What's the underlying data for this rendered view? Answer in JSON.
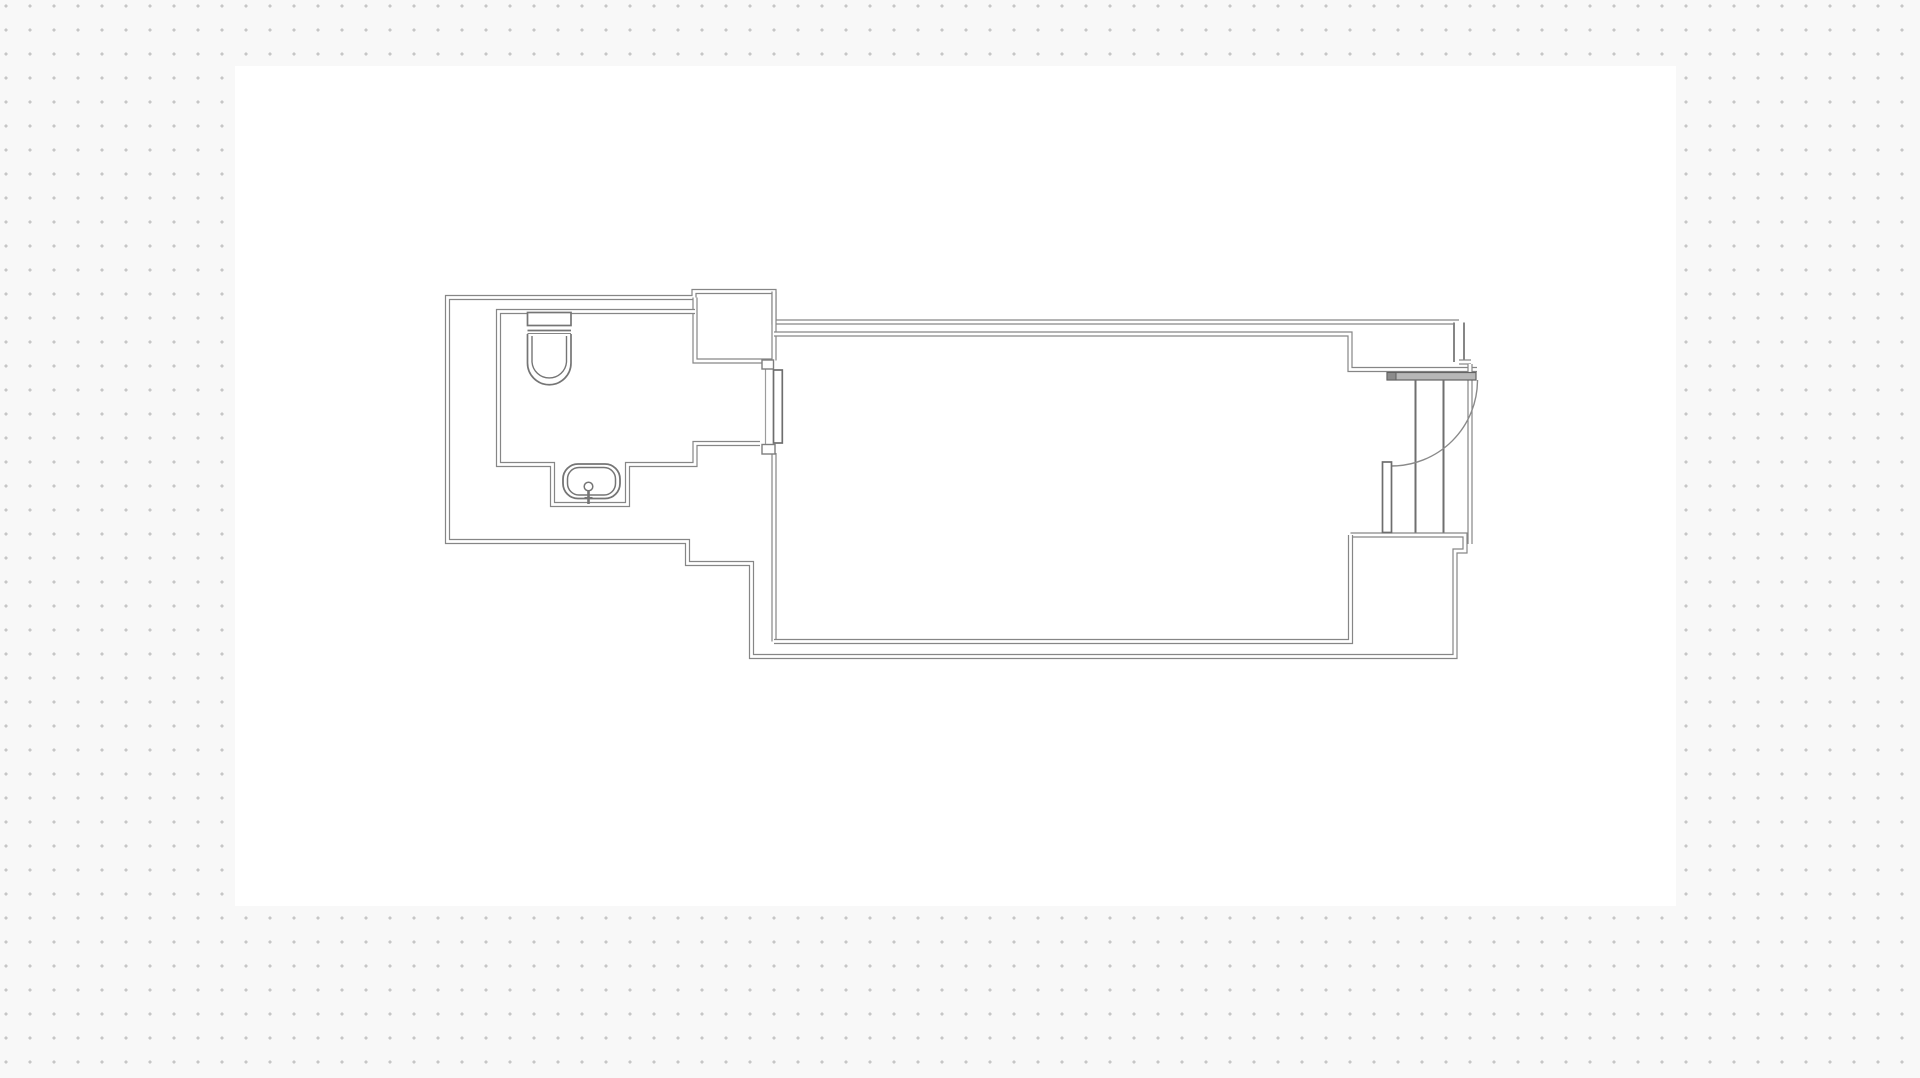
{
  "canvas": {
    "width": 1920,
    "height": 1078,
    "background_color": "#f8f8f8",
    "dot_color": "#c6c6c6",
    "dot_spacing_px": 24,
    "artboard": {
      "x": 235,
      "y": 66,
      "width": 1441,
      "height": 840,
      "color": "#ffffff"
    }
  },
  "floorplan": {
    "wall_color": "#868686",
    "wall_core_color": "#ffffff",
    "fixture_color": "#757575",
    "detail_color": "#6f6f6f",
    "walls": [
      {
        "name": "wall-outer-boundary",
        "d": "M 1350.5 535 H 1465 V 551 H 1455 V 656.5 H 751.5 V 563.5 H 687.5 V 541.5 H 447.5 V 297.5 H 694 V 291.5 H 774 V 322 H 1459",
        "thick": false
      },
      {
        "name": "wall-top-right-corner",
        "d": "M 1459 322.5 V 362",
        "thick": true
      },
      {
        "name": "wall-top-right-step",
        "d": "M 1459 362 H 1471",
        "thick": false
      },
      {
        "name": "wall-closet-niche",
        "d": "M 695 297.5 V 361 H 773",
        "thick": false
      },
      {
        "name": "wall-hall-upper",
        "d": "M 774 291.5 V 360.5",
        "thick": false
      },
      {
        "name": "wall-hall-lower",
        "d": "M 774 453 V 641.5",
        "thick": false
      },
      {
        "name": "wall-bathroom",
        "d": "M 695 311.5 H 498.5 V 464.5 H 552.5 V 504.5 H 627.5 V 464.5 H 695 V 443.5 H 760",
        "thick": false
      },
      {
        "name": "wall-main-room-top-inner",
        "d": "M 774 334 H 1350 V 369.5 H 1477",
        "thick": false
      },
      {
        "name": "wall-main-room-bottom-inner",
        "d": "M 774 641.5 H 1350.5 V 535",
        "thick": false
      },
      {
        "name": "wall-entry-jamb",
        "d": "M 1470 364 V 544",
        "thick": false
      }
    ],
    "bathroom_door": {
      "sill": "M 765.5 366 V 447",
      "leaf": {
        "x": 773.5,
        "y": 370,
        "width": 8.8,
        "height": 73
      },
      "caps": [
        {
          "x": 762,
          "y": 360,
          "width": 11.5,
          "height": 9
        },
        {
          "x": 762,
          "y": 444.5,
          "width": 13,
          "height": 9.5
        }
      ]
    },
    "entry_door": {
      "threshold": {
        "x": 1387,
        "y": 372.5,
        "width": 89,
        "height": 7.5,
        "fill": "#b7b7b7",
        "stroke": "#636363"
      },
      "cap": {
        "x": 1387,
        "y": 372.5,
        "width": 9,
        "height": 7.5,
        "fill": "#8b8b8b",
        "stroke": "#5f5f5f"
      },
      "tracks": [
        "M 1415.5 380 V 532.5",
        "M 1443.5 380 V 532.5"
      ],
      "swing_arc": "M 1477.5 380 A 86 86 0 0 1 1391.5 466",
      "leaf": {
        "x": 1382.5,
        "y": 462,
        "width": 9,
        "height": 70.5
      }
    },
    "toilet": {
      "tank": {
        "x": 527.5,
        "y": 312.5,
        "width": 43.5,
        "height": 13
      },
      "seam": [
        "M 527.5 330.5 H 571",
        "M 527.5 334 H 571"
      ],
      "bowl_outer": "M 527.5 334 L 527.5 363 A 21.75 21.75 0 0 0 571 363 L 571 334",
      "bowl_inner": "M 532 336 L 532 362 A 17.3 17.3 0 0 0 566.5 362 L 566.5 336"
    },
    "sink": {
      "basin_outer": {
        "x": 563,
        "y": 464,
        "width": 57,
        "height": 34.5,
        "rx": 15
      },
      "basin_inner": {
        "x": 567.5,
        "y": 467.5,
        "width": 48,
        "height": 27.5,
        "rx": 11.5
      },
      "drain": {
        "cx": 588.5,
        "cy": 486.5,
        "r": 4.3
      },
      "faucet_stem": "M 588.5 490.8 V 504",
      "faucet_bar": "M 584.5 497.5 H 592.5"
    }
  }
}
